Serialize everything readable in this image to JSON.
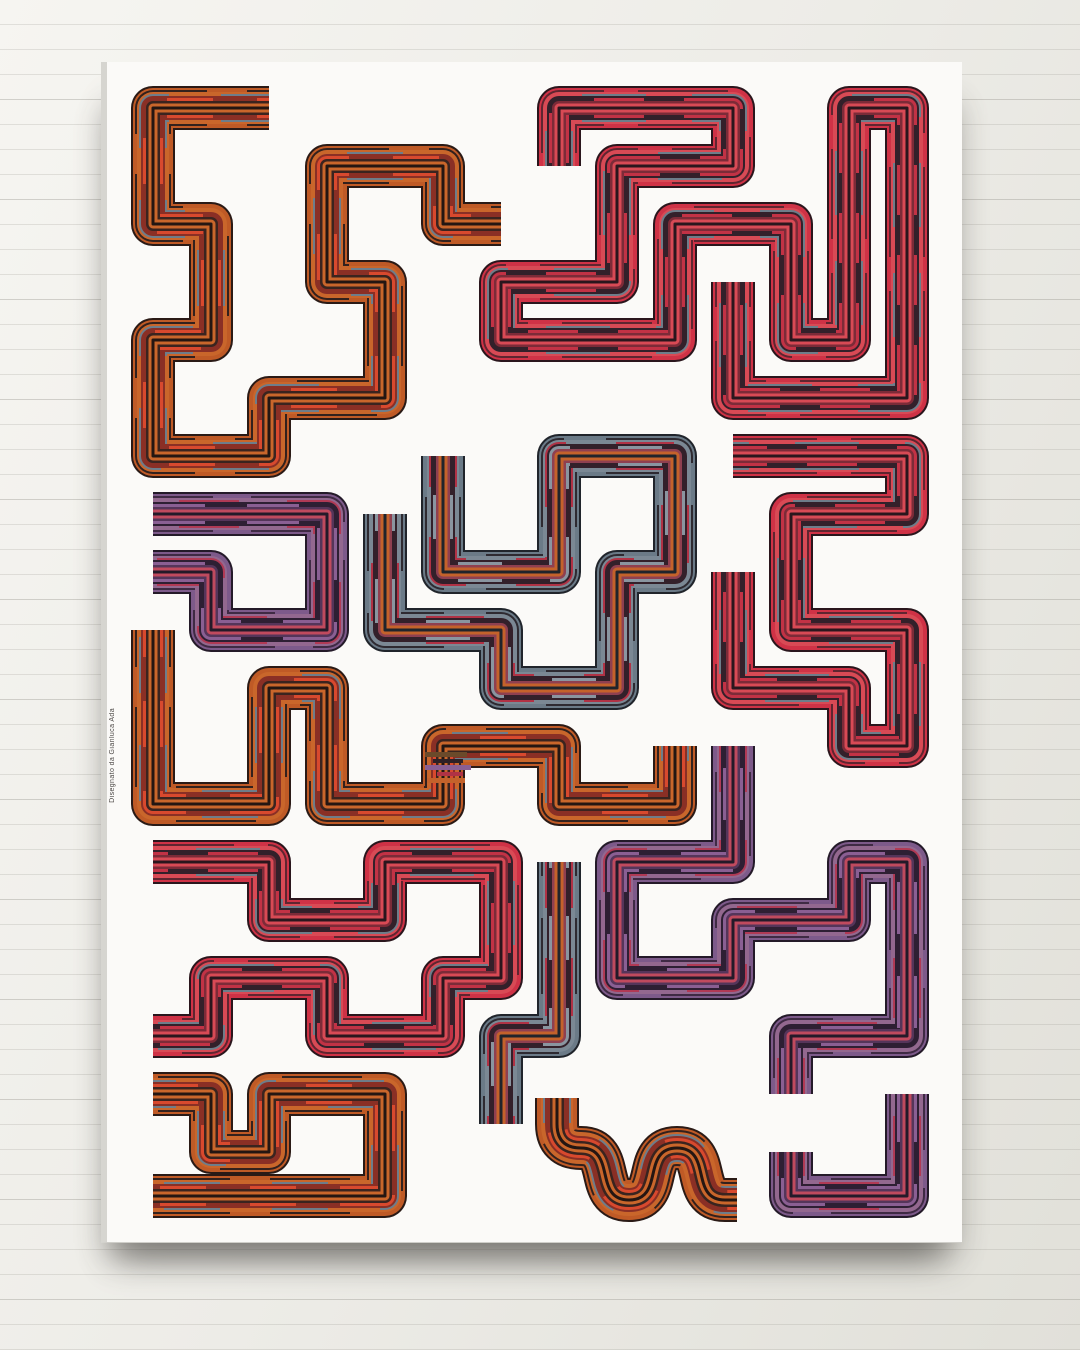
{
  "scene": {
    "wall": {
      "base_light": "#f6f5f1",
      "base_dark": "#e1e0d9",
      "panel_line_color": "#928e88",
      "panel_line_spacing_px": 25
    },
    "canvas": {
      "face_color": "#fbfaf8",
      "edge_color": "#d6d5d0",
      "shadow_color": "#4b4944"
    }
  },
  "artwork": {
    "signature": "Disegnato da Gianluca Ada",
    "band_width": 44,
    "accent_colors": {
      "red": "#cf3246",
      "orange": "#bf5a26",
      "purple": "#7d5a8a",
      "slate": "#6b7a87",
      "dark": "#2a161d"
    },
    "palettes": {
      "red": [
        {
          "w": 44,
          "c": "#2a161d"
        },
        {
          "w": 40,
          "c": "#cf3246"
        },
        {
          "w": 36,
          "c": "#5f2530",
          "dash": [
            90,
            34
          ]
        },
        {
          "w": 32,
          "c": "#d84a55"
        },
        {
          "w": 28,
          "c": "#6e7d8a",
          "dash": [
            64,
            46
          ]
        },
        {
          "w": 24,
          "c": "#33202a"
        },
        {
          "w": 20,
          "c": "#c23245",
          "dash": [
            50,
            40
          ]
        },
        {
          "w": 14,
          "c": "#7c2b38"
        },
        {
          "w": 9,
          "c": "#d84a55"
        },
        {
          "w": 3,
          "c": "#2a161d"
        }
      ],
      "orange": [
        {
          "w": 44,
          "c": "#2a1a16"
        },
        {
          "w": 40,
          "c": "#bf5a26"
        },
        {
          "w": 36,
          "c": "#33211d",
          "dash": [
            80,
            40
          ]
        },
        {
          "w": 32,
          "c": "#c9662b"
        },
        {
          "w": 28,
          "c": "#6e7d8a",
          "dash": [
            56,
            52
          ]
        },
        {
          "w": 24,
          "c": "#8a2f25"
        },
        {
          "w": 20,
          "c": "#d8492e",
          "dash": [
            46,
            44
          ]
        },
        {
          "w": 14,
          "c": "#3a241f"
        },
        {
          "w": 9,
          "c": "#c9662b"
        },
        {
          "w": 3,
          "c": "#241612"
        }
      ],
      "purple": [
        {
          "w": 44,
          "c": "#241a29"
        },
        {
          "w": 40,
          "c": "#7d5a8a"
        },
        {
          "w": 36,
          "c": "#3f2a44",
          "dash": [
            84,
            38
          ]
        },
        {
          "w": 32,
          "c": "#93688f"
        },
        {
          "w": 28,
          "c": "#b03a55",
          "dash": [
            60,
            48
          ]
        },
        {
          "w": 24,
          "c": "#2e1f33"
        },
        {
          "w": 20,
          "c": "#8a5f93",
          "dash": [
            52,
            42
          ]
        },
        {
          "w": 14,
          "c": "#55355a"
        },
        {
          "w": 9,
          "c": "#c04a5e"
        },
        {
          "w": 3,
          "c": "#241a29"
        }
      ],
      "slate": [
        {
          "w": 44,
          "c": "#20242b"
        },
        {
          "w": 40,
          "c": "#6b7a87"
        },
        {
          "w": 36,
          "c": "#2e2a31",
          "dash": [
            76,
            42
          ]
        },
        {
          "w": 32,
          "c": "#7b8894"
        },
        {
          "w": 28,
          "c": "#b03245",
          "dash": [
            58,
            50
          ]
        },
        {
          "w": 24,
          "c": "#33202a"
        },
        {
          "w": 20,
          "c": "#8a95a0",
          "dash": [
            44,
            48
          ]
        },
        {
          "w": 14,
          "c": "#8f4050"
        },
        {
          "w": 9,
          "c": "#c4622b"
        },
        {
          "w": 3,
          "c": "#20242b"
        }
      ]
    },
    "paths": [
      {
        "name": "top-left-orange",
        "palette": "orange",
        "points": [
          [
            162,
            46
          ],
          [
            46,
            46
          ],
          [
            46,
            162
          ],
          [
            104,
            162
          ],
          [
            104,
            278
          ],
          [
            46,
            278
          ],
          [
            46,
            394
          ],
          [
            162,
            394
          ],
          [
            162,
            336
          ],
          [
            278,
            336
          ],
          [
            278,
            220
          ],
          [
            220,
            220
          ],
          [
            220,
            104
          ],
          [
            336,
            104
          ],
          [
            336,
            162
          ],
          [
            394,
            162
          ]
        ]
      },
      {
        "name": "top-right-red",
        "palette": "red",
        "points": [
          [
            452,
            104
          ],
          [
            452,
            46
          ],
          [
            626,
            46
          ],
          [
            626,
            104
          ],
          [
            510,
            104
          ],
          [
            510,
            220
          ],
          [
            394,
            220
          ],
          [
            394,
            278
          ],
          [
            568,
            278
          ],
          [
            568,
            162
          ],
          [
            684,
            162
          ],
          [
            684,
            278
          ],
          [
            742,
            278
          ],
          [
            742,
            46
          ],
          [
            800,
            46
          ],
          [
            800,
            336
          ],
          [
            626,
            336
          ],
          [
            626,
            220
          ]
        ]
      },
      {
        "name": "mid-left-purple",
        "palette": "purple",
        "points": [
          [
            46,
            452
          ],
          [
            220,
            452
          ],
          [
            220,
            568
          ],
          [
            104,
            568
          ],
          [
            104,
            510
          ],
          [
            46,
            510
          ]
        ]
      },
      {
        "name": "center-slate",
        "palette": "slate",
        "points": [
          [
            336,
            394
          ],
          [
            336,
            510
          ],
          [
            452,
            510
          ],
          [
            452,
            394
          ],
          [
            568,
            394
          ],
          [
            568,
            510
          ],
          [
            510,
            510
          ],
          [
            510,
            626
          ],
          [
            394,
            626
          ],
          [
            394,
            568
          ],
          [
            278,
            568
          ],
          [
            278,
            452
          ]
        ]
      },
      {
        "name": "mid-right-red",
        "palette": "red",
        "points": [
          [
            626,
            394
          ],
          [
            800,
            394
          ],
          [
            800,
            452
          ],
          [
            684,
            452
          ],
          [
            684,
            568
          ],
          [
            800,
            568
          ],
          [
            800,
            684
          ],
          [
            742,
            684
          ],
          [
            742,
            626
          ],
          [
            626,
            626
          ],
          [
            626,
            510
          ]
        ]
      },
      {
        "name": "lower-left-orange",
        "palette": "orange",
        "points": [
          [
            46,
            568
          ],
          [
            46,
            742
          ],
          [
            162,
            742
          ],
          [
            162,
            626
          ],
          [
            220,
            626
          ],
          [
            220,
            742
          ],
          [
            336,
            742
          ],
          [
            336,
            684
          ],
          [
            452,
            684
          ],
          [
            452,
            742
          ],
          [
            568,
            742
          ],
          [
            568,
            684
          ]
        ]
      },
      {
        "name": "lower-right-purple",
        "palette": "purple",
        "points": [
          [
            626,
            684
          ],
          [
            626,
            800
          ],
          [
            510,
            800
          ],
          [
            510,
            916
          ],
          [
            626,
            916
          ],
          [
            626,
            858
          ],
          [
            742,
            858
          ],
          [
            742,
            800
          ],
          [
            800,
            800
          ],
          [
            800,
            974
          ],
          [
            684,
            974
          ],
          [
            684,
            1032
          ]
        ]
      },
      {
        "name": "bottom-left-red",
        "palette": "red",
        "points": [
          [
            46,
            800
          ],
          [
            162,
            800
          ],
          [
            162,
            858
          ],
          [
            278,
            858
          ],
          [
            278,
            800
          ],
          [
            394,
            800
          ],
          [
            394,
            916
          ],
          [
            336,
            916
          ],
          [
            336,
            974
          ],
          [
            220,
            974
          ],
          [
            220,
            916
          ],
          [
            104,
            916
          ],
          [
            104,
            974
          ],
          [
            46,
            974
          ]
        ]
      },
      {
        "name": "bottom-center-slate",
        "palette": "slate",
        "points": [
          [
            452,
            800
          ],
          [
            452,
            974
          ],
          [
            394,
            974
          ],
          [
            394,
            1062
          ]
        ]
      },
      {
        "name": "bottom-left-orange",
        "palette": "orange",
        "points": [
          [
            46,
            1032
          ],
          [
            104,
            1032
          ],
          [
            104,
            1090
          ],
          [
            162,
            1090
          ],
          [
            162,
            1032
          ],
          [
            278,
            1032
          ],
          [
            278,
            1134
          ],
          [
            46,
            1134
          ]
        ]
      },
      {
        "name": "bottom-right-purple",
        "palette": "purple",
        "points": [
          [
            800,
            1032
          ],
          [
            800,
            1134
          ],
          [
            684,
            1134
          ],
          [
            684,
            1090
          ]
        ]
      },
      {
        "name": "bottom-squiggle-orange",
        "palette": "orange",
        "d": "M 450 1036 L 450 1062 Q 450 1086 474 1086 C 510 1086 486 1138 522 1138 C 558 1138 534 1086 570 1086 C 606 1086 582 1138 618 1138 L 630 1138"
      }
    ],
    "glitch_bars": [
      {
        "x": 318,
        "y": 690,
        "w": 42,
        "h": 5,
        "c": "#6b4a2a"
      },
      {
        "x": 326,
        "y": 697,
        "w": 30,
        "h": 4,
        "c": "#2e2026"
      },
      {
        "x": 318,
        "y": 703,
        "w": 46,
        "h": 5,
        "c": "#8a5f93"
      },
      {
        "x": 330,
        "y": 710,
        "w": 26,
        "h": 4,
        "c": "#b03245"
      },
      {
        "x": 320,
        "y": 716,
        "w": 38,
        "h": 5,
        "c": "#c4622b"
      }
    ]
  }
}
